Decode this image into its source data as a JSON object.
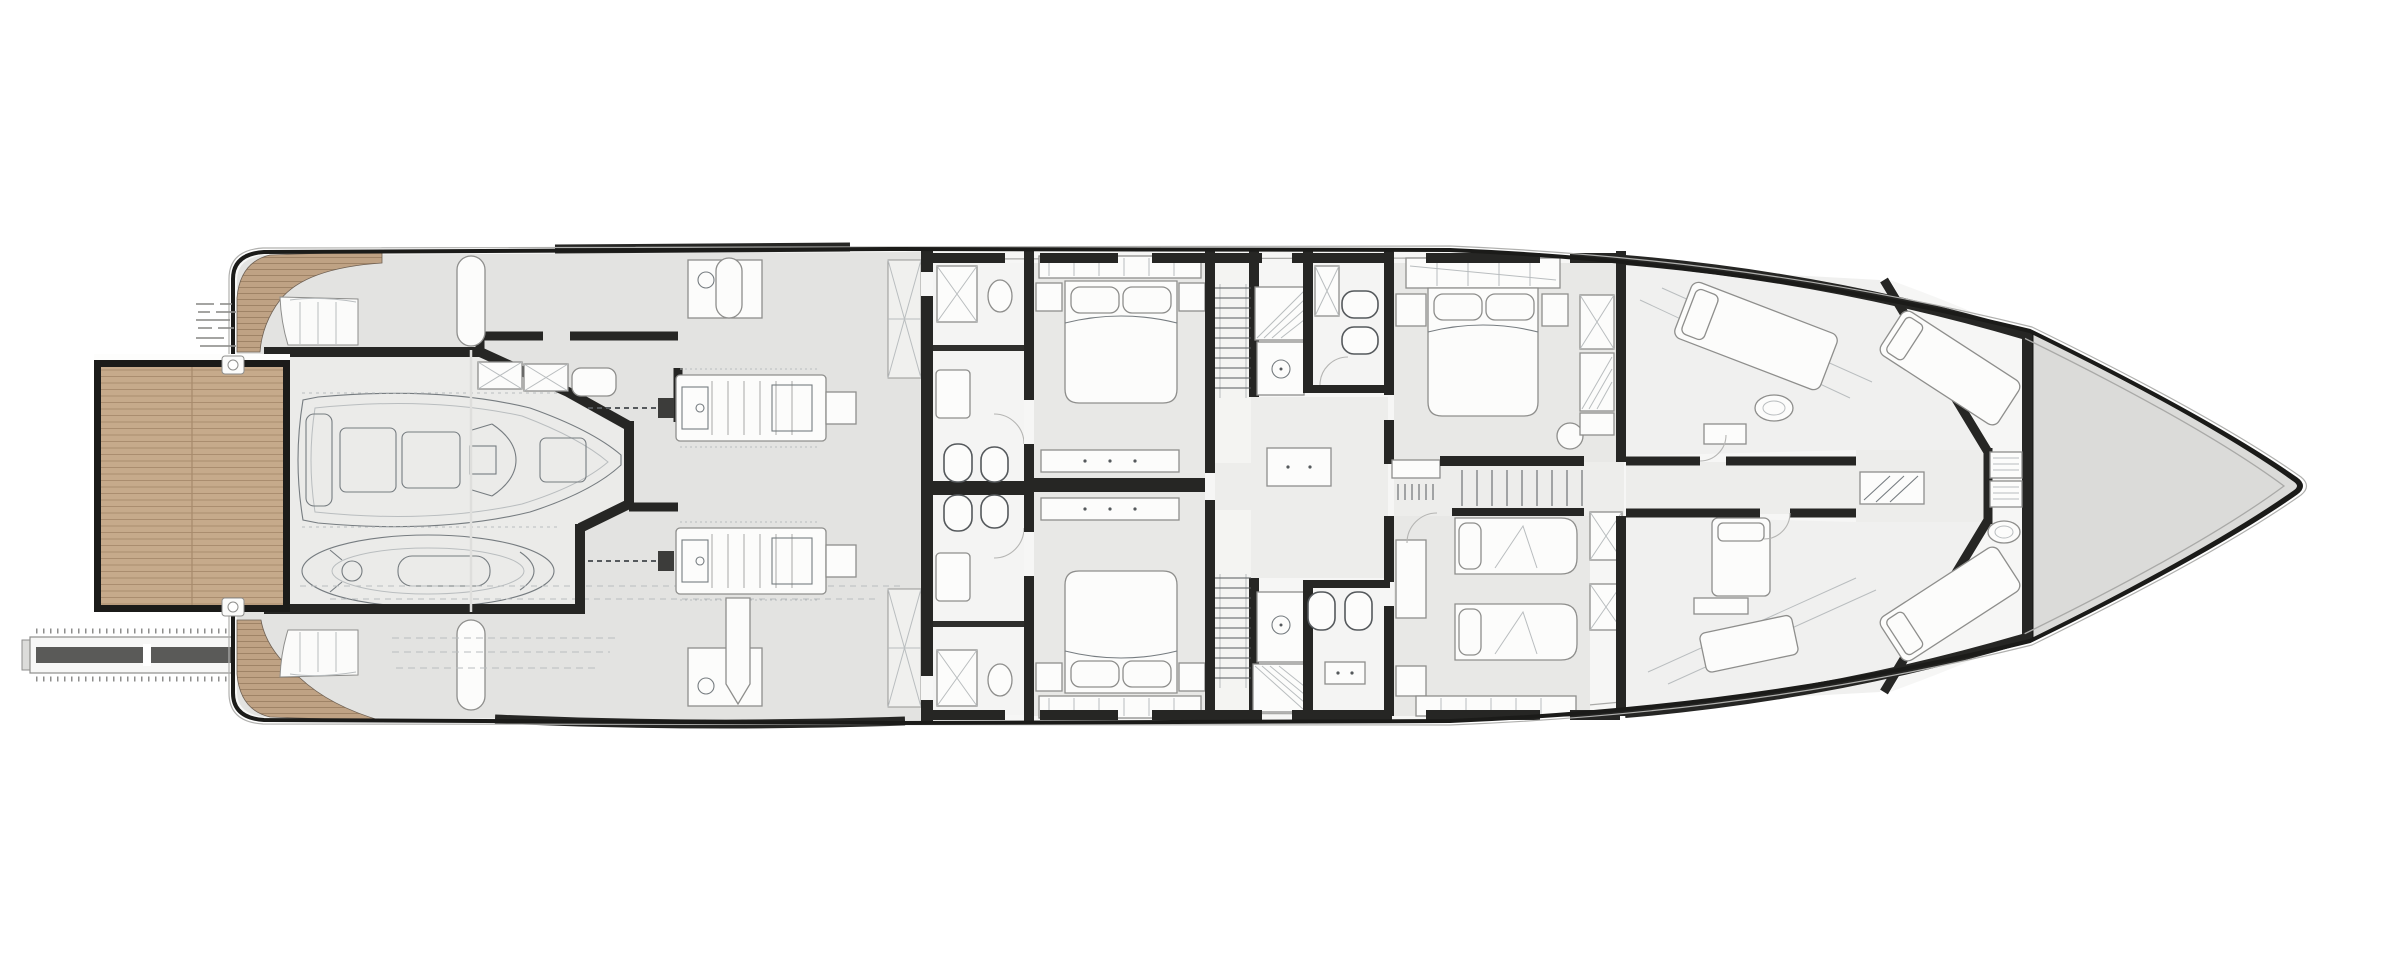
{
  "canvas": {
    "width": 2400,
    "height": 973
  },
  "palette": {
    "background": "#ffffff",
    "hull": "#1b1b19",
    "hull-outer-line": "#b0b0ae",
    "inner-line": "#a9a9a7",
    "wall": "#262624",
    "deck-gray": "#e3e3e1",
    "garage-floor": "#ebebe9",
    "cabin-floor": "#e8e8e6",
    "fwd-floor": "#f0f0ef",
    "bath-floor": "#f4f4f3",
    "lobby-floor": "#ededeb",
    "bow-gray": "#dbdbd9",
    "base-floor": "#f6f6f5",
    "teak": "#bfa284",
    "teak-line": "#9c8063",
    "teak-light": "#c6aa8b",
    "teak-light-line": "#a78a6c",
    "white": "#fcfcfb",
    "line": "#8e8e8c",
    "sketch": "#767c80",
    "faint": "#b9bdbf",
    "dark-bar": "#5a5a58"
  }
}
